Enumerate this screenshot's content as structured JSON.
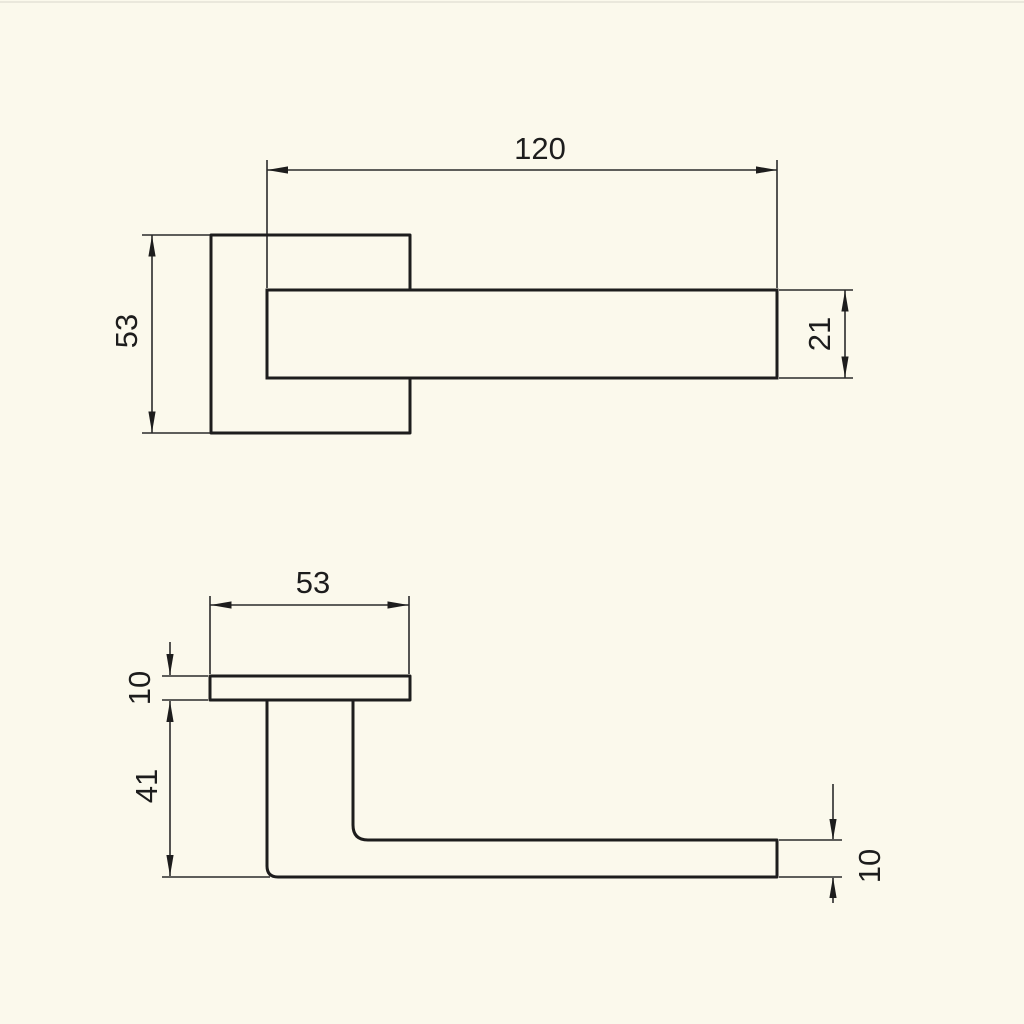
{
  "diagram": {
    "type": "technical-drawing",
    "subject": "door-handle-with-square-rosette",
    "colors": {
      "background": "#fbf9ec",
      "line": "#1d1d1d"
    },
    "views": {
      "front": {
        "lever_length": "120",
        "rosette_size": "53",
        "lever_width": "21"
      },
      "side": {
        "rosette_width": "53",
        "rosette_thickness": "10",
        "handle_height": "41",
        "lever_thickness": "10"
      }
    }
  }
}
